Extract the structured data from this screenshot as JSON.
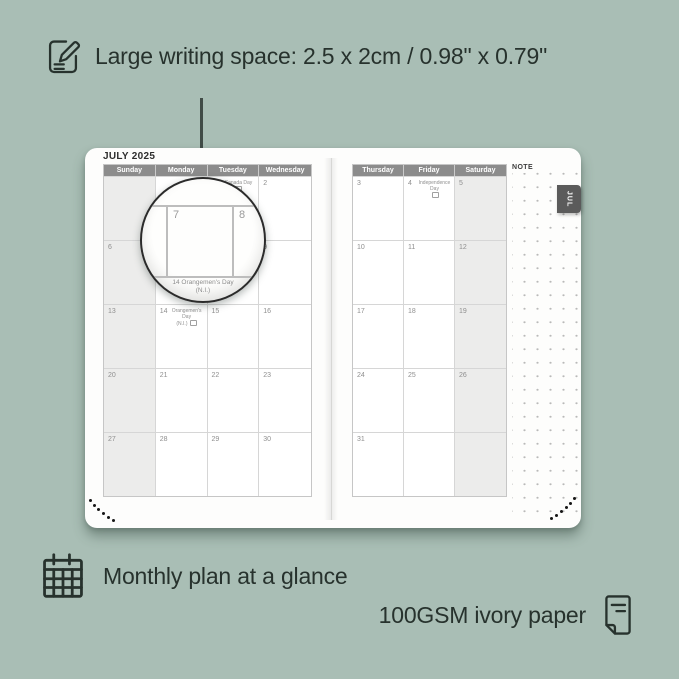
{
  "colors": {
    "background": "#a9beb5",
    "caption_text": "#27322d",
    "page": "#fdfdfc",
    "header_bg": "#8c8c8c",
    "header_text": "#ffffff",
    "weekend_bg": "#ececeb",
    "grid_line": "#c6c6c6",
    "date_text": "#8f8f8f",
    "tab_bg": "#5b5b5b"
  },
  "captions": {
    "writing_space": "Large writing space: 2.5 x 2cm / 0.98\" x 0.79\"",
    "monthly_plan": "Monthly plan at a glance",
    "paper": "100GSM ivory paper"
  },
  "planner": {
    "month_title": "JULY 2025",
    "tab_label": "JUL",
    "note_label": "NOTE",
    "left_headers": [
      "Sunday",
      "Monday",
      "Tuesday",
      "Wednesday"
    ],
    "right_headers": [
      "Thursday",
      "Friday",
      "Saturday"
    ],
    "left_weekend_col": 0,
    "right_weekend_col": 2,
    "left_cells": [
      {
        "d": ""
      },
      {
        "d": ""
      },
      {
        "d": "1",
        "h": "Canada Day"
      },
      {
        "d": "2"
      },
      {
        "d": "6"
      },
      {
        "d": "7"
      },
      {
        "d": "8"
      },
      {
        "d": "9"
      },
      {
        "d": "13"
      },
      {
        "d": "14",
        "h": "Orangemen's Day",
        "h2": "(N.I.)"
      },
      {
        "d": "15"
      },
      {
        "d": "16"
      },
      {
        "d": "20"
      },
      {
        "d": "21"
      },
      {
        "d": "22"
      },
      {
        "d": "23"
      },
      {
        "d": "27"
      },
      {
        "d": "28"
      },
      {
        "d": "29"
      },
      {
        "d": "30"
      }
    ],
    "right_cells": [
      {
        "d": "3"
      },
      {
        "d": "4",
        "h": "Independence Day"
      },
      {
        "d": "5"
      },
      {
        "d": "10"
      },
      {
        "d": "11"
      },
      {
        "d": "12"
      },
      {
        "d": "17"
      },
      {
        "d": "18"
      },
      {
        "d": "19"
      },
      {
        "d": "24"
      },
      {
        "d": "25"
      },
      {
        "d": "26"
      },
      {
        "d": "31"
      },
      {
        "d": ""
      },
      {
        "d": ""
      }
    ],
    "magnifier": {
      "day_a": "7",
      "day_b": "8",
      "caption_line1": "14 Orangemen's Day",
      "caption_line2": "(N.I.)"
    }
  },
  "icons": {
    "writing": "pencil-note-icon",
    "monthly": "calendar-grid-icon",
    "paper": "paper-sheet-icon"
  }
}
